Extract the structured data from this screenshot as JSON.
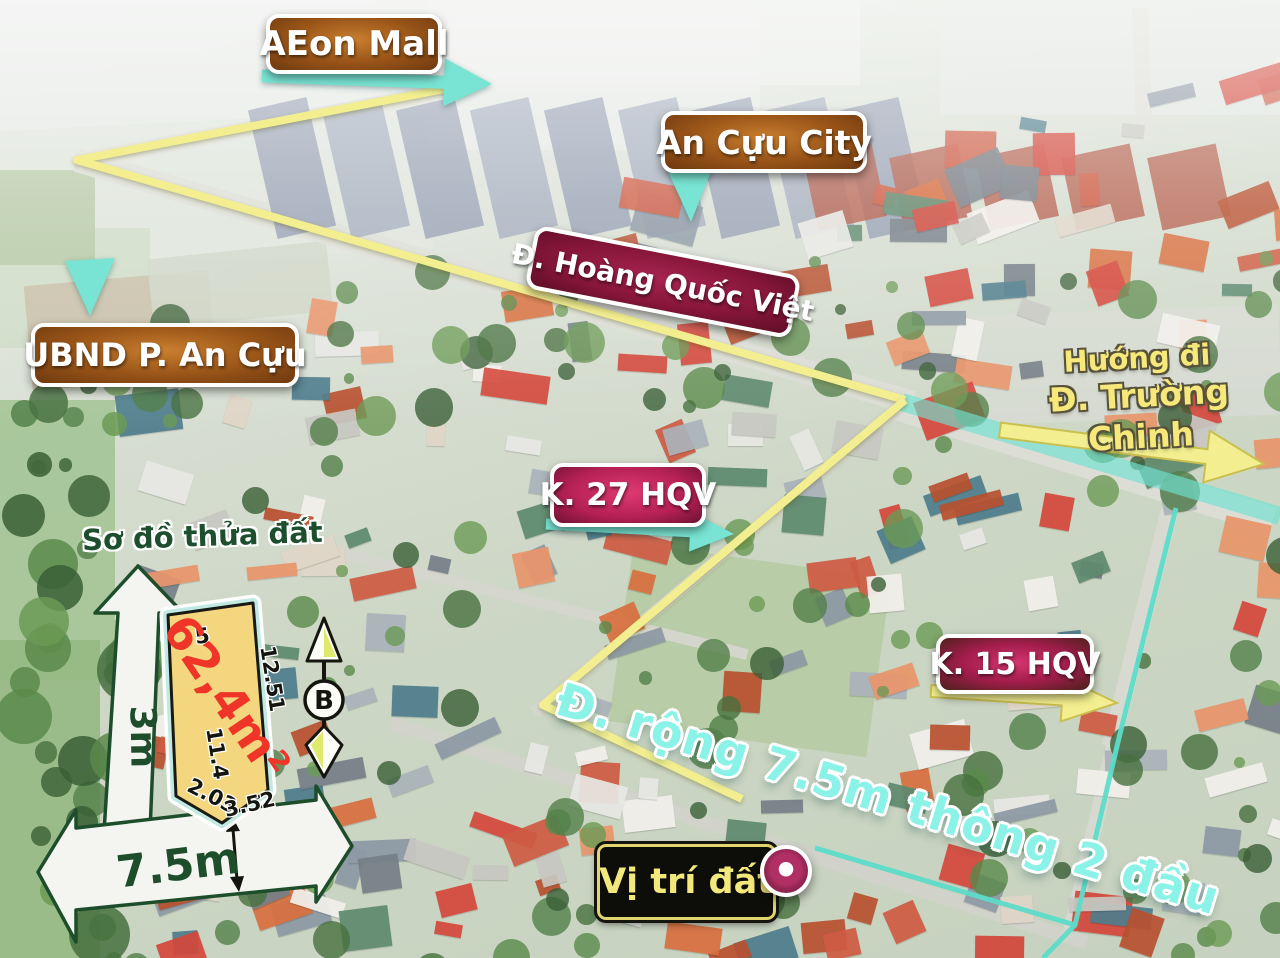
{
  "labels": {
    "aeon_mall": "AEon Mall",
    "an_cuu_city": "An Cựu City",
    "hoang_quoc_viet": "Đ. Hoàng Quốc Việt",
    "ubnd_an_cuu": "UBND P. An Cựu",
    "truong_chinh_line1": "Hướng đi",
    "truong_chinh_line2": "Đ. Trường Chinh",
    "k27_hqv": "K. 27 HQV",
    "k15_hqv": "K. 15 HQV",
    "plot_diagram_title": "Sơ đồ thửa đất",
    "road_width_note": "Đ. rộng 7.5m thông 2 đầu",
    "land_position": "Vị trí đất"
  },
  "plot": {
    "area": "62,4m²",
    "edge_top": "5",
    "edge_right": "12.51",
    "edge_left": "11.4",
    "edge_bottom_left": "2.03",
    "edge_bottom_right": "3.52",
    "road_vertical_width": "3m",
    "road_horizontal_width": "7.5m",
    "compass_north": "B"
  },
  "colors": {
    "brown_badge": "#9a5518",
    "maroon_badge": "#87163a",
    "magenta_badge": "#b52055",
    "teal_arrow": "#79e4d3",
    "yellow_route": "#f3ef90",
    "yellow_arrow_edge": "#c9c050",
    "cyan_route": "#5ddcc9",
    "cyan_band": "#6fe3d2",
    "cyan_text": "#8bf2e8",
    "yellow_text": "#f6e87a",
    "dark_green_text": "#1d4d2b",
    "plot_fill": "#f4d67e",
    "plot_glow": "#bfe9e2",
    "area_red": "#ee3528",
    "marker_magenta": "#b13063"
  }
}
